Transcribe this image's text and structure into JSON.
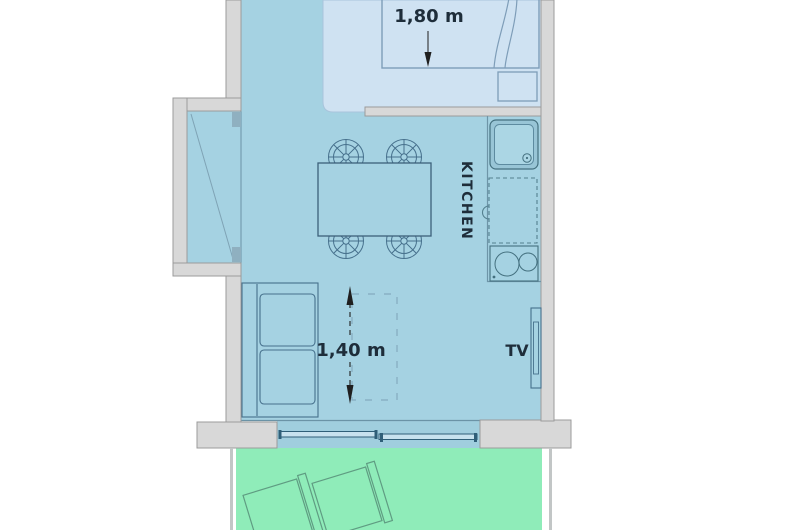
{
  "labels": {
    "bed_dimension": "1,80 m",
    "sofa_dimension": "1,40 m",
    "kitchen": "KITCHEN",
    "tv": "TV"
  },
  "colors": {
    "living_floor": "#a5d2e2",
    "bedroom_floor": "#cfe2f2",
    "terrace_floor": "#8fecb9",
    "door_band": "#a0cede",
    "wall_fill": "#d8d8d8",
    "wall_outline": "#9b9b9b",
    "furniture_outline": "#46708c",
    "bed_outline": "#7e9db8",
    "kitchen_outline": "#44707f",
    "terrace_chair_outline": "#5f9c82",
    "label_text": "#1e2d3a",
    "dimension_mark": "#1f1f1f"
  }
}
